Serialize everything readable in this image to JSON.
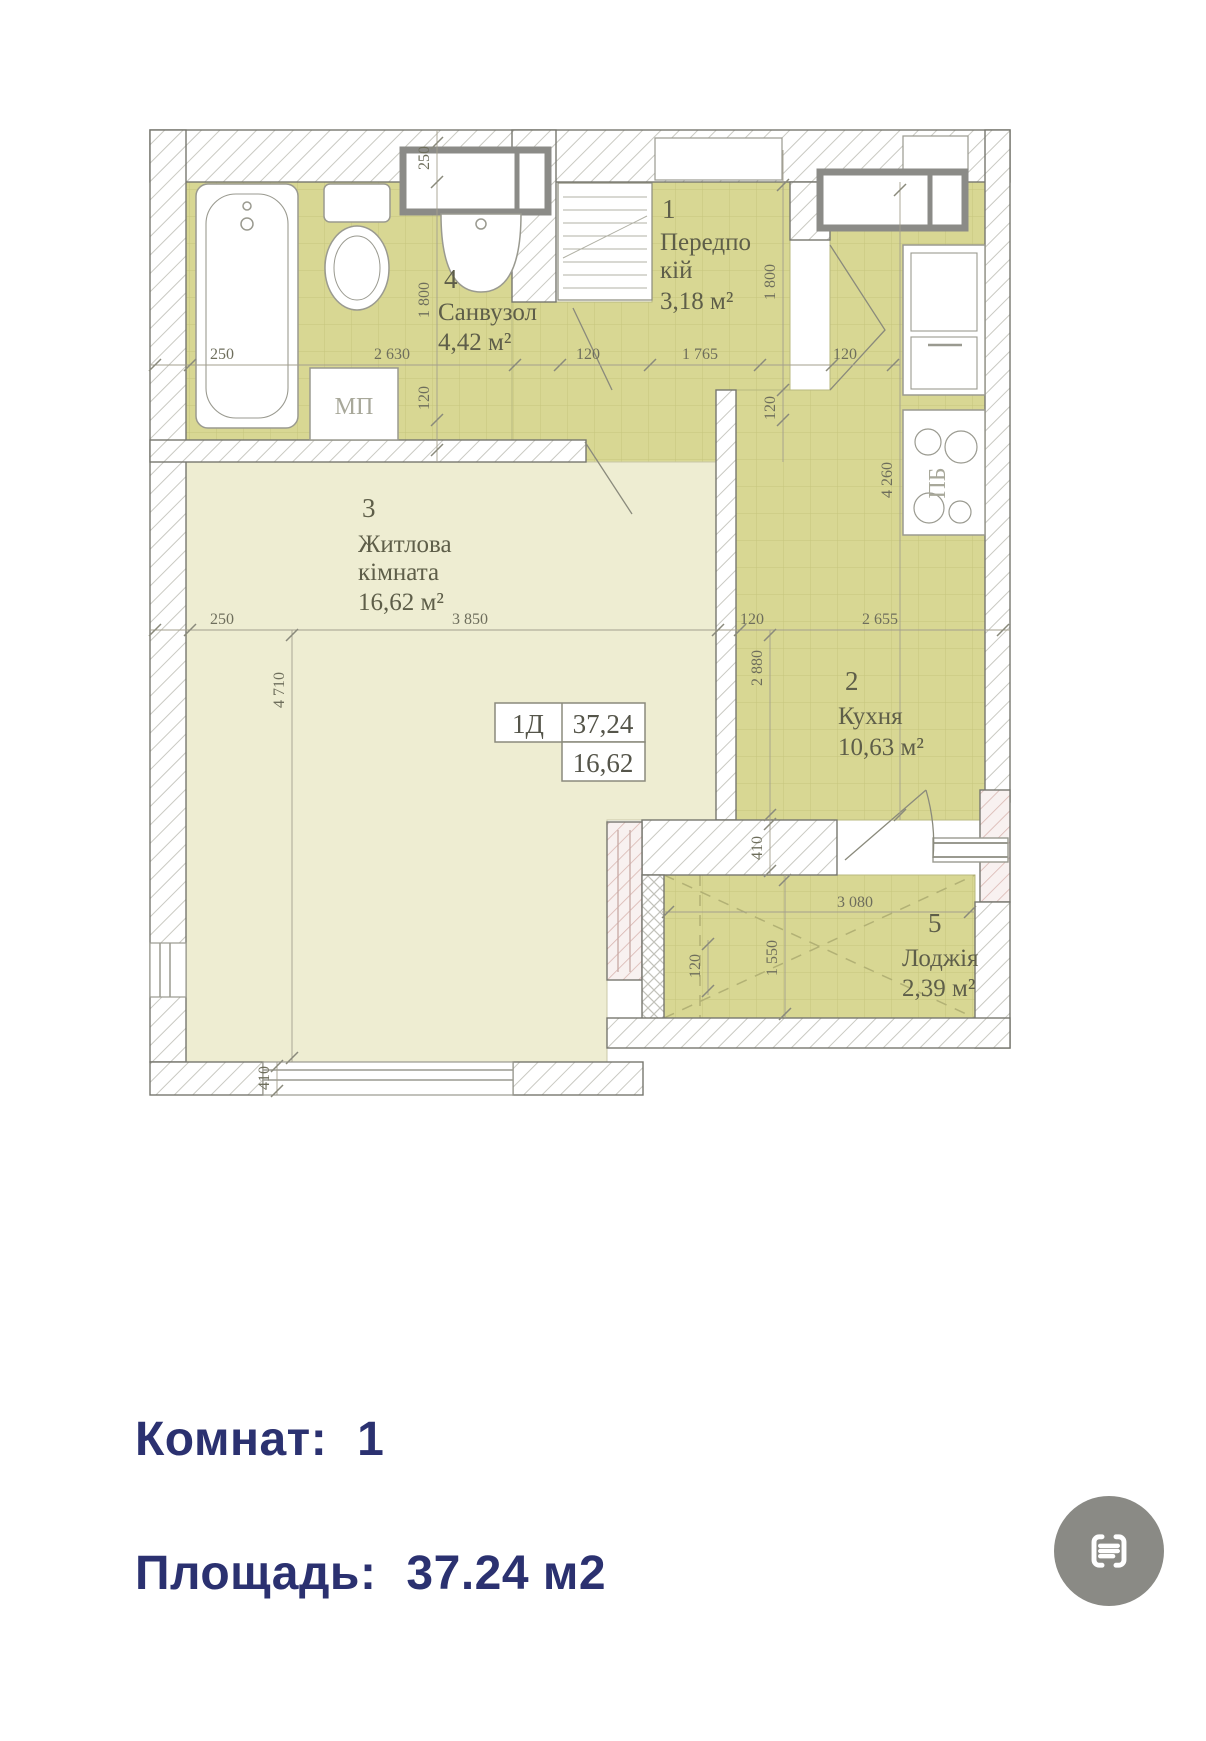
{
  "plan": {
    "info_box": {
      "unit": "1Д",
      "total_area": "37,24",
      "living_area": "16,62"
    },
    "rooms": [
      {
        "number": "1",
        "name1": "Передпо",
        "name2": "кій",
        "area": "3,18 м²"
      },
      {
        "number": "2",
        "name1": "Кухня",
        "name2": "",
        "area": "10,63 м²"
      },
      {
        "number": "3",
        "name1": "Житлова",
        "name2": "кімната",
        "area": "16,62 м²"
      },
      {
        "number": "4",
        "name1": "Санвузол",
        "name2": "",
        "area": "4,42 м²"
      },
      {
        "number": "5",
        "name1": "Лоджія",
        "name2": "",
        "area": "2,39 м²"
      }
    ],
    "fixtures": {
      "washing_machine": "МП",
      "stove": "ПБ"
    },
    "dims": {
      "top_wall": "250",
      "bath_height": "1 800",
      "bath_offset": "120",
      "tub_width": "250",
      "bath_width": "2 630",
      "hall_offset": "120",
      "hall_width": "1 765",
      "kitchen_door": "120",
      "hall_height": "1 800",
      "hall_offset2": "120",
      "kitchen_height": "4 260",
      "wall_left": "250",
      "living_width": "3 850",
      "wall_gap": "120",
      "kitchen_width": "2 655",
      "kitchen_inner": "2 880",
      "living_height": "4 710",
      "loggia_wall": "410",
      "loggia_width": "3 080",
      "loggia_height": "1 550",
      "loggia_offset": "120",
      "bottom_offset": "410"
    }
  },
  "summary": {
    "rooms_label": "Комнат:",
    "rooms_value": "1",
    "area_label": "Площадь:",
    "area_value": "37.24 м2"
  },
  "colors": {
    "accent_navy": "#2b3170",
    "tile_fill": "#d8d793",
    "living_fill": "#eeedd2",
    "icon_gray": "#8a8a85"
  }
}
